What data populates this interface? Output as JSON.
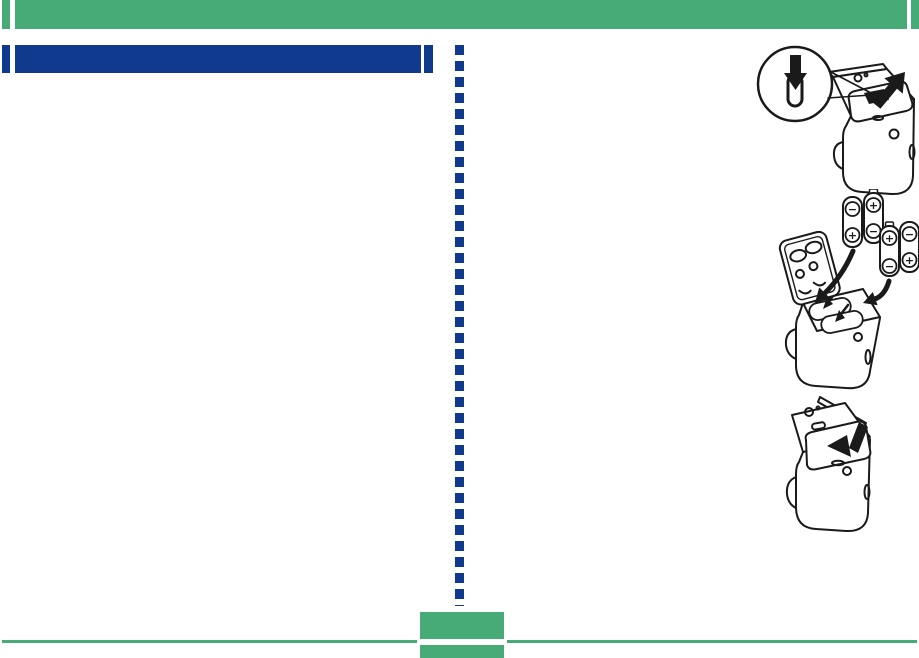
{
  "colors": {
    "green": "#47AB77",
    "blue": "#0F3A8E",
    "ink": "#1A1A1A",
    "paper": "#FFFFFF"
  },
  "title_bar": {
    "label": ""
  },
  "footer": {
    "page_label": ""
  },
  "symbols": {
    "minus": "−",
    "plus": "+"
  },
  "figures": [
    {
      "id": "step-1",
      "icon": "press-latch-and-slide-cover-open"
    },
    {
      "id": "step-2",
      "icon": "insert-four-batteries"
    },
    {
      "id": "step-3",
      "icon": "slide-cover-closed"
    }
  ]
}
